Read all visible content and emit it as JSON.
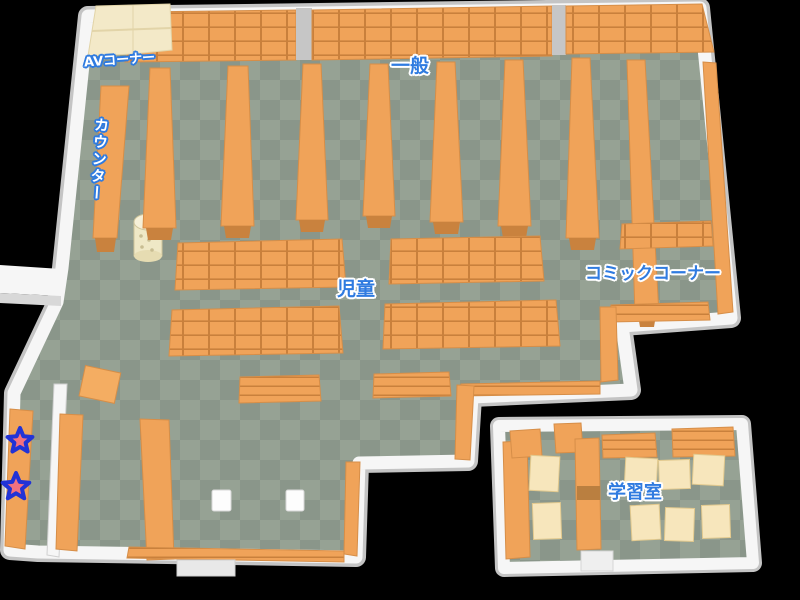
{
  "map": {
    "type": "library-floor-map",
    "background": "#000000",
    "labels": {
      "av_corner": "AVコーナー",
      "counter": "カウンター",
      "general": "一般",
      "children": "児童",
      "comic_corner": "コミックコーナー",
      "study_room": "学習室"
    },
    "markers": {
      "star_count": 2,
      "stars": [
        {
          "name": "star-marker-upper",
          "fill": "#F4717F",
          "outline": "#2233D6"
        },
        {
          "name": "star-marker-lower",
          "fill": "#F4717F",
          "outline": "#2233D6"
        }
      ]
    },
    "colors": {
      "floor_light": "#96A294",
      "floor_dark": "#8A968A",
      "wall": "#F6F6F6",
      "wall_shade": "#C4C4C4",
      "shelf_orange": "#F0A359",
      "shelf_line": "#C9803C",
      "shelf_cap": "#C9823E",
      "desk_cream": "#F3E9C8",
      "table_cream": "#F7E6BC",
      "label_blue": "#2F7BE0",
      "label_white": "#FFFFFF",
      "star_fill": "#F4717F",
      "star_outline": "#2233D6"
    }
  }
}
